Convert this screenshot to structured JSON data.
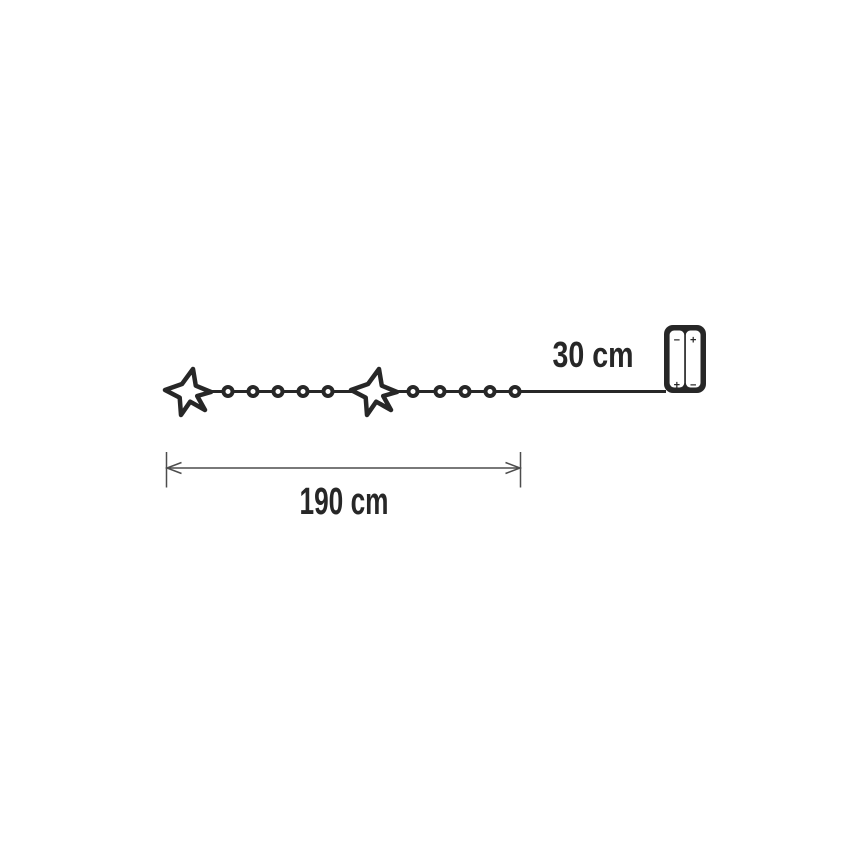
{
  "diagram": {
    "background_color": "#ffffff",
    "ink_color": "#272727",
    "dimension_line_color": "#4d4d4d",
    "light_string": {
      "line_y": 391.5,
      "line_start_x": 190,
      "wire_end_x": 666,
      "star_centers_x": [
        188,
        374
      ],
      "star_center_y": 392,
      "bulb_centers_x": [
        228,
        253,
        278,
        303,
        328,
        413,
        440,
        465,
        490,
        515
      ],
      "star_count": 2,
      "bulb_count": 10
    },
    "battery_box": {
      "cells": [
        {
          "top_mark": "−",
          "bottom_mark": "+"
        },
        {
          "top_mark": "+",
          "bottom_mark": "−"
        }
      ]
    },
    "dimensions": {
      "string_length": {
        "label": "190 cm"
      },
      "lead_length": {
        "label": "30 cm"
      }
    }
  }
}
